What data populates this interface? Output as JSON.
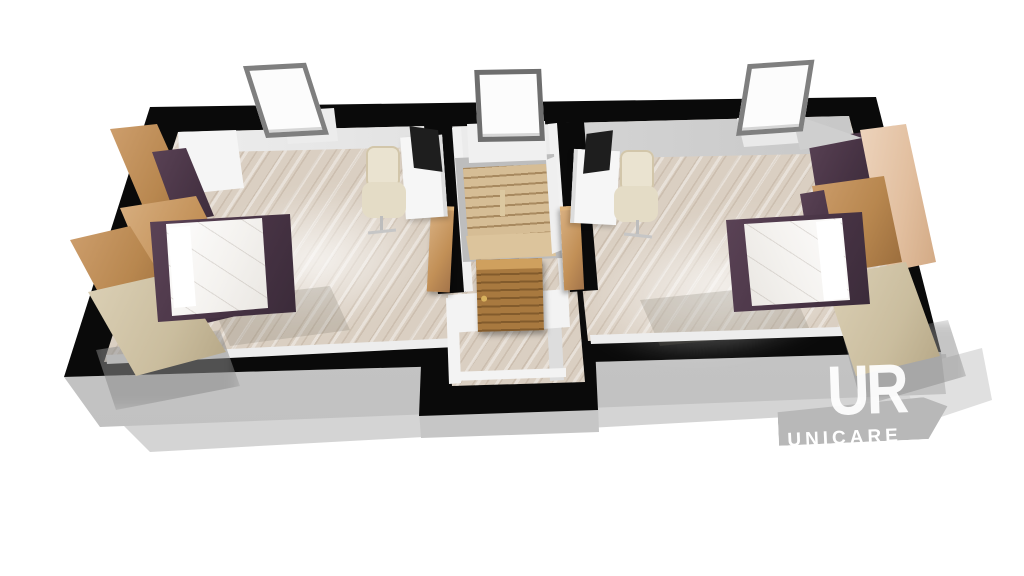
{
  "scene": {
    "title": "3D floor plan render – upper storey with two mirrored bedrooms and central stair hall",
    "background": "#ffffff",
    "view": "elevated three-quarter top view, white studio background with soft drop shadow"
  },
  "watermark": {
    "monogram": "UR",
    "subtext": "UNICARE",
    "subtext_note": "only the top slivers of the letters are visible above the banner edge",
    "banner_color": "#b8b8b8",
    "text_color": "#ffffff"
  },
  "building": {
    "wall_color": "#0a0a0a",
    "slab_color": "#c6c6c6",
    "floor_material": "light oak plank flooring",
    "windows": [
      {
        "name": "left roof window",
        "frame_color": "#7f7f7f"
      },
      {
        "name": "middle roof window",
        "frame_color": "#6e6e6e"
      },
      {
        "name": "right roof window",
        "frame_color": "#7f7f7f"
      }
    ]
  },
  "rooms": [
    {
      "name": "left bedroom",
      "items": [
        "double bed with white duvet and aubergine frame",
        "oak wardrobe units with aubergine fronts",
        "light ash dresser",
        "white desk",
        "black monitor",
        "beige office chair",
        "roof window"
      ]
    },
    {
      "name": "stair hall",
      "items": [
        "timber staircase going down",
        "stair landing",
        "closed slatted oak door",
        "left open door leaf",
        "right open door leaf",
        "roof window"
      ]
    },
    {
      "name": "right bedroom",
      "items": [
        "double bed with white duvet and aubergine frame",
        "oak and blush wardrobe units with aubergine fronts",
        "light ash dresser",
        "white desk",
        "black monitor",
        "beige office chair",
        "roof window"
      ]
    }
  ],
  "palette": {
    "oak": "#b8874f",
    "aubergine": "#473344",
    "ash": "#cabd9e",
    "blush_wood": "#e2bf9f",
    "floor": "#dacfc2",
    "stairs": "#c9ac82",
    "desk": "#f5f5f5",
    "chair": "#e9e2cf",
    "monitor": "#1e1e1e"
  }
}
